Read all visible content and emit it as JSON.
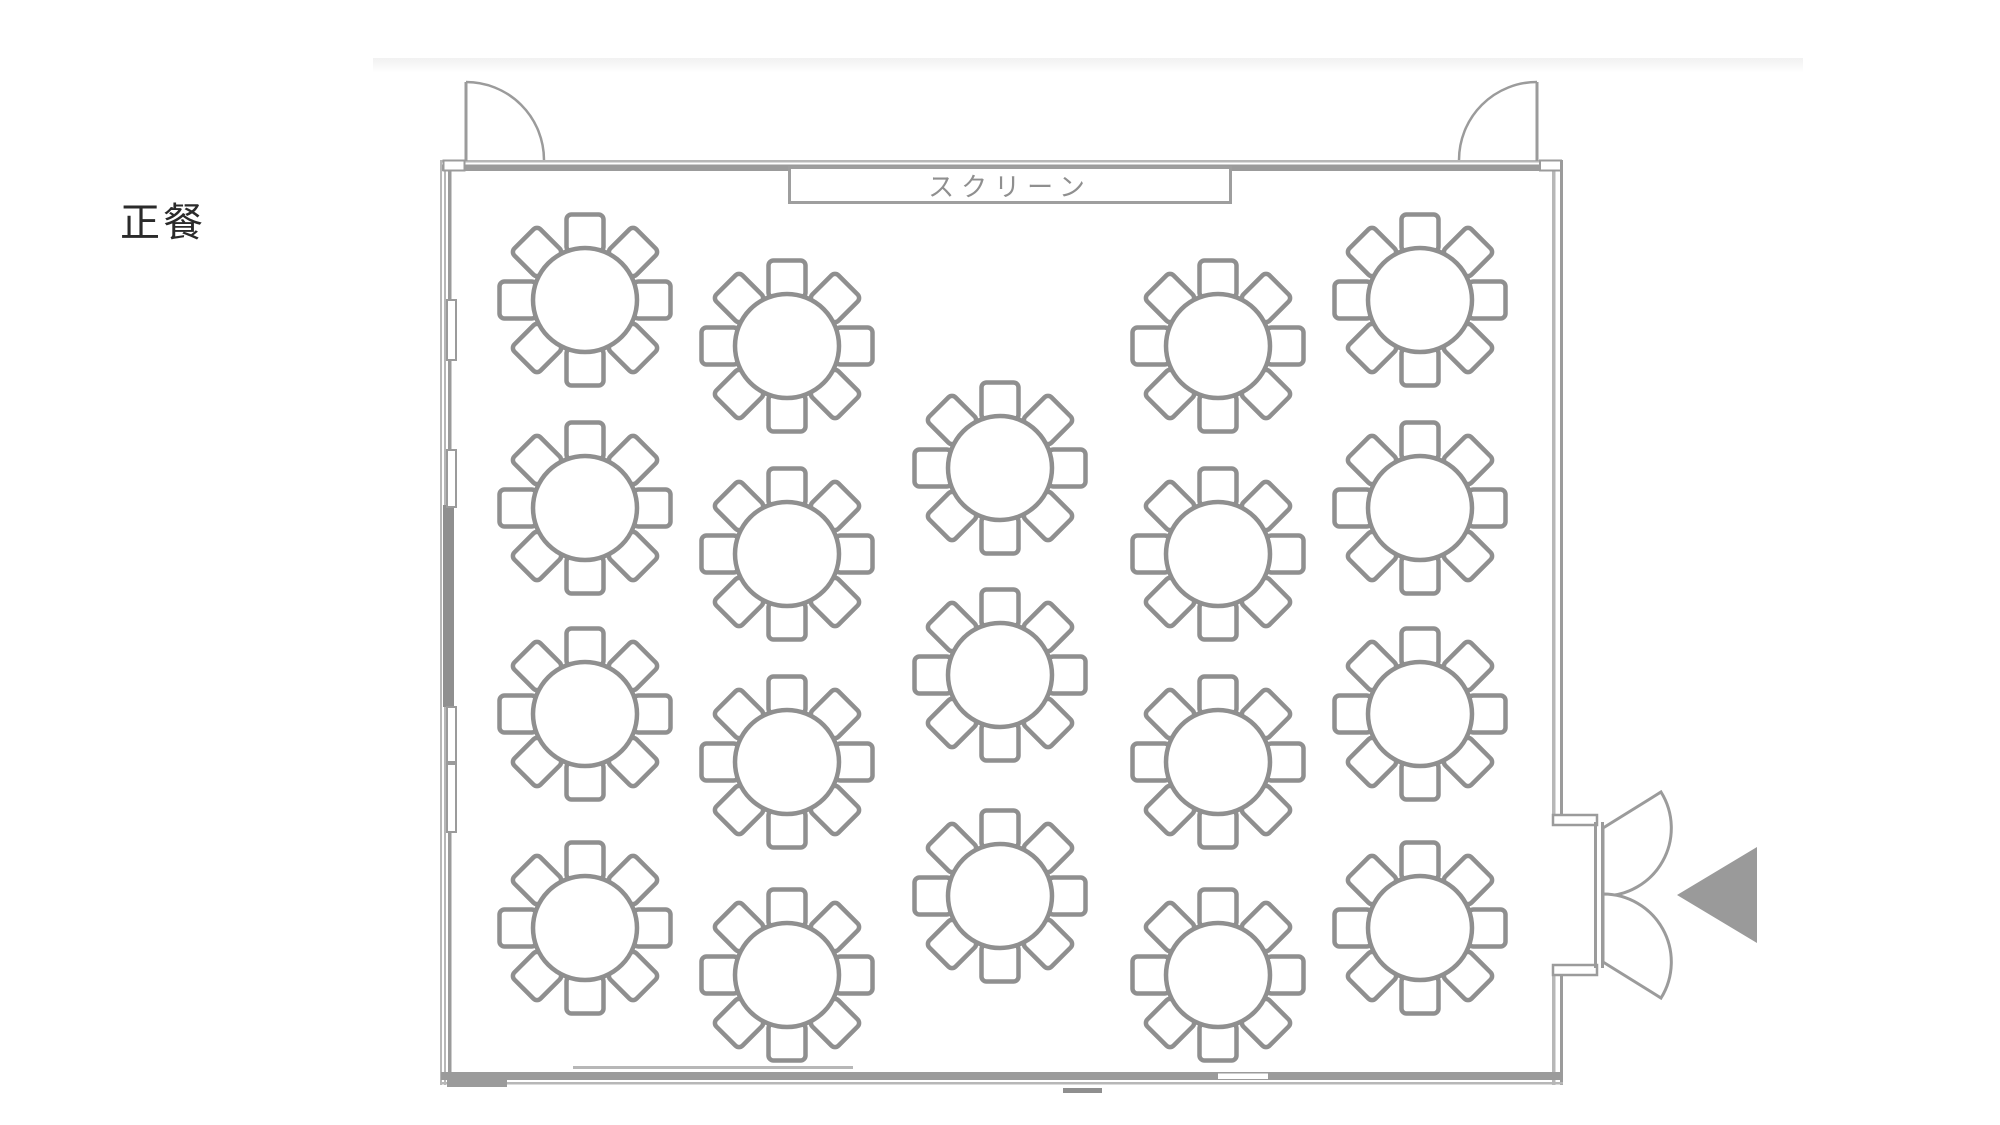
{
  "page": {
    "background": "#ffffff",
    "top_band": {
      "x": 373,
      "y": 58,
      "width": 1430,
      "height": 15,
      "color": "#f1f1f1"
    },
    "title": {
      "text": "正餐",
      "x": 120,
      "y": 190,
      "font_size": 40,
      "color": "#2a2a2a"
    }
  },
  "screen_label": {
    "text": "スクリーン",
    "x": 788,
    "y": 166,
    "width": 444,
    "height": 38,
    "border_color": "#9e9e9e",
    "text_color": "#8f8f8f",
    "font_size": 26,
    "letter_spacing": 7
  },
  "room": {
    "outer": {
      "x": 441,
      "y": 158,
      "width": 1122,
      "height": 927
    },
    "wall_color_main": "#9b9b9b",
    "wall_color_light": "#b7b7b7",
    "wall_color_dark": "#8f8f8f"
  },
  "doors": {
    "top_left": {
      "hinge_x": 466,
      "wall_y": 160,
      "panel_top_y": 82,
      "width": 78,
      "swing": "right"
    },
    "top_right": {
      "hinge_x": 1537,
      "wall_y": 160,
      "panel_top_y": 82,
      "width": 78,
      "swing": "left"
    },
    "right_double": {
      "frame_x": 1593,
      "opening_top": 822,
      "opening_bottom": 968,
      "hinge_top_y": 828,
      "hinge_bottom_y": 962,
      "leaf_radius": 68,
      "tip_dx": 58,
      "tip_dy": 36,
      "jamb_top_y": 815,
      "jamb_bottom_y": 965,
      "jamb_w": 44,
      "jamb_h": 10
    },
    "entrance_arrow": {
      "tip_x": 1677,
      "tip_y": 895,
      "base_x": 1757,
      "base_top_y": 847,
      "base_bottom_y": 943,
      "color": "#9a9a9a"
    }
  },
  "tables": {
    "count": 19,
    "seats_per_table": 8,
    "radius": 52,
    "chair": {
      "size": 37,
      "corner_radius": 5,
      "cardinal_offset": 67,
      "diagonal_offset": 48
    },
    "stroke_color": "#8f8f8f",
    "fill": "#ffffff",
    "stroke_width": 4.5,
    "positions": [
      {
        "x": 585,
        "y": 300
      },
      {
        "x": 585,
        "y": 508
      },
      {
        "x": 585,
        "y": 714
      },
      {
        "x": 585,
        "y": 928
      },
      {
        "x": 787,
        "y": 346
      },
      {
        "x": 787,
        "y": 554
      },
      {
        "x": 787,
        "y": 762
      },
      {
        "x": 787,
        "y": 975
      },
      {
        "x": 1000,
        "y": 468
      },
      {
        "x": 1000,
        "y": 675
      },
      {
        "x": 1000,
        "y": 896
      },
      {
        "x": 1218,
        "y": 346
      },
      {
        "x": 1218,
        "y": 554
      },
      {
        "x": 1218,
        "y": 762
      },
      {
        "x": 1218,
        "y": 975
      },
      {
        "x": 1420,
        "y": 300
      },
      {
        "x": 1420,
        "y": 508
      },
      {
        "x": 1420,
        "y": 714
      },
      {
        "x": 1420,
        "y": 928
      }
    ]
  }
}
